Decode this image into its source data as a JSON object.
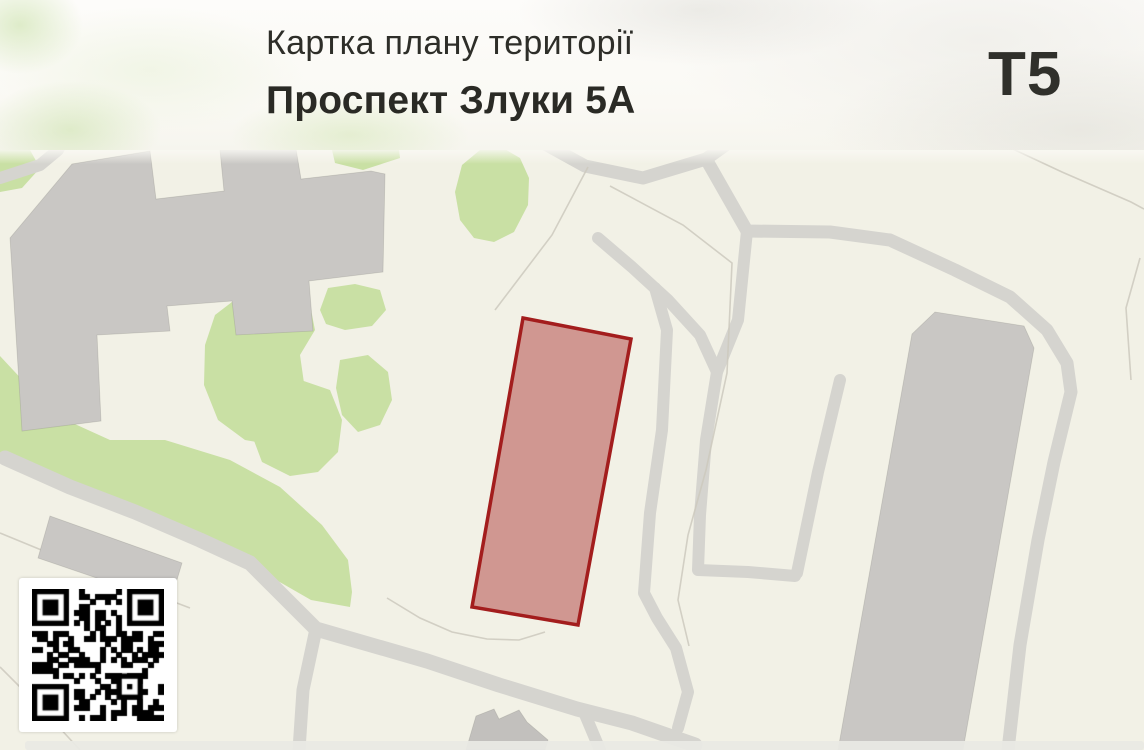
{
  "header": {
    "title": "Картка плану території",
    "subtitle": "Проспект Злуки 5А",
    "badge": "Т5"
  },
  "map": {
    "parcel": {
      "points": [
        [
          523,
          318
        ],
        [
          631,
          339
        ],
        [
          578,
          625
        ],
        [
          472,
          607
        ]
      ],
      "fill": "rgba(166,42,42,0.45)",
      "stroke": "#a31d1d",
      "stroke_width": 3.5
    }
  },
  "qr": {
    "modules": 25,
    "seed": 7,
    "dark": "#000000",
    "light": "#ffffff"
  },
  "colors": {
    "map_bg": "#f2f1e6",
    "road": "#d5d4cf",
    "green": "#c9e0a4",
    "building": "#c9c7c4",
    "thin_line": "#ccc9bd",
    "strip": "#e9e9e4"
  }
}
